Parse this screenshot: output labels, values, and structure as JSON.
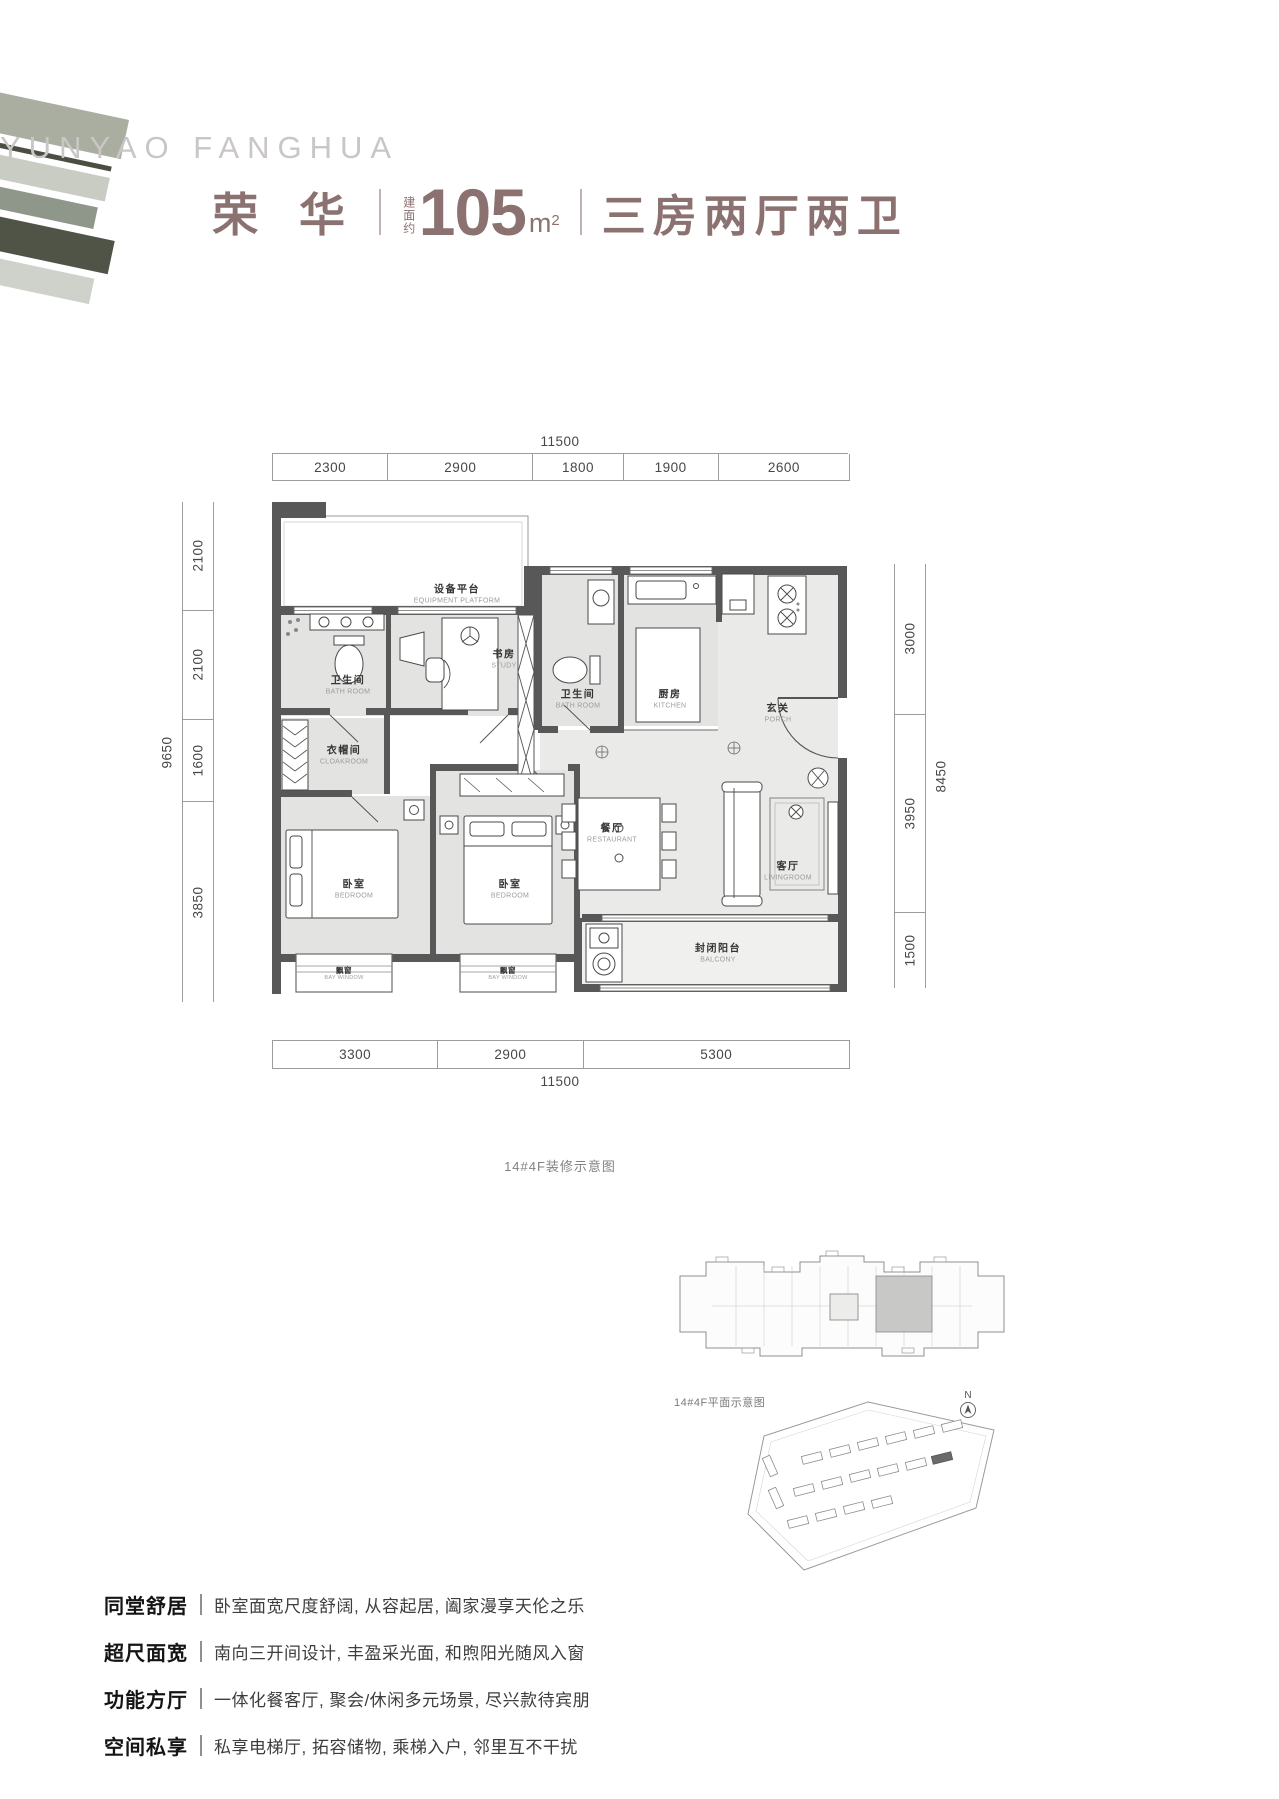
{
  "header": {
    "brand_en": "YUNYAO  FANGHUA",
    "name": "荣 华",
    "area_prefix": "建面约",
    "area_value": "105",
    "area_unit": "m",
    "area_sup": "2",
    "layout": "三房两厅两卫",
    "accent_color": "#8B7270"
  },
  "dimensions": {
    "top": {
      "total": "11500",
      "segments": [
        "2300",
        "2900",
        "1800",
        "1900",
        "2600"
      ]
    },
    "bottom": {
      "total": "11500",
      "segments": [
        "3300",
        "2900",
        "5300"
      ]
    },
    "left": {
      "total": "9650",
      "segments": [
        "2100",
        "2100",
        "1600",
        "3850"
      ]
    },
    "right": {
      "total": "8450",
      "segments": [
        "3000",
        "3950",
        "1500"
      ]
    }
  },
  "plan": {
    "caption": "14#4F装修示意图",
    "wall_color": "#585858",
    "floor_color": "#E3E3E1",
    "rooms": [
      {
        "cn": "设备平台",
        "en": "EQUIPMENT PLATFORM"
      },
      {
        "cn": "卫生间",
        "en": "BATH ROOM"
      },
      {
        "cn": "书房",
        "en": "STUDY"
      },
      {
        "cn": "卫生间",
        "en": "BATH ROOM"
      },
      {
        "cn": "厨房",
        "en": "KITCHEN"
      },
      {
        "cn": "玄关",
        "en": "PORCH"
      },
      {
        "cn": "衣帽间",
        "en": "CLOAKROOM"
      },
      {
        "cn": "卧室",
        "en": "BEDROOM"
      },
      {
        "cn": "卧室",
        "en": "BEDROOM"
      },
      {
        "cn": "餐厅",
        "en": "RESTAURANT"
      },
      {
        "cn": "客厅",
        "en": "LIVINGROOM"
      },
      {
        "cn": "封闭阳台",
        "en": "BALCONY"
      },
      {
        "cn": "飘窗",
        "en": "BAY WINDOW"
      },
      {
        "cn": "飘窗",
        "en": "BAY WINDOW"
      }
    ]
  },
  "floorplate": {
    "caption": "14#4F平面示意图"
  },
  "siteplan": {
    "north": "N"
  },
  "features": [
    {
      "label": "同堂舒居",
      "text": "卧室面宽尺度舒阔, 从容起居, 阖家漫享天伦之乐"
    },
    {
      "label": "超尺面宽",
      "text": "南向三开间设计, 丰盈采光面, 和煦阳光随风入窗"
    },
    {
      "label": "功能方厅",
      "text": "一体化餐客厅, 聚会/休闲多元场景, 尽兴款待宾朋"
    },
    {
      "label": "空间私享",
      "text": "私享电梯厅, 拓容储物, 乘梯入户, 邻里互不干扰"
    }
  ],
  "colors": {
    "stripes": [
      "#A9AEA1",
      "#4A4F42",
      "#C9CCC2",
      "#8E978A",
      "#4F5447",
      "#CFD2CA"
    ]
  }
}
